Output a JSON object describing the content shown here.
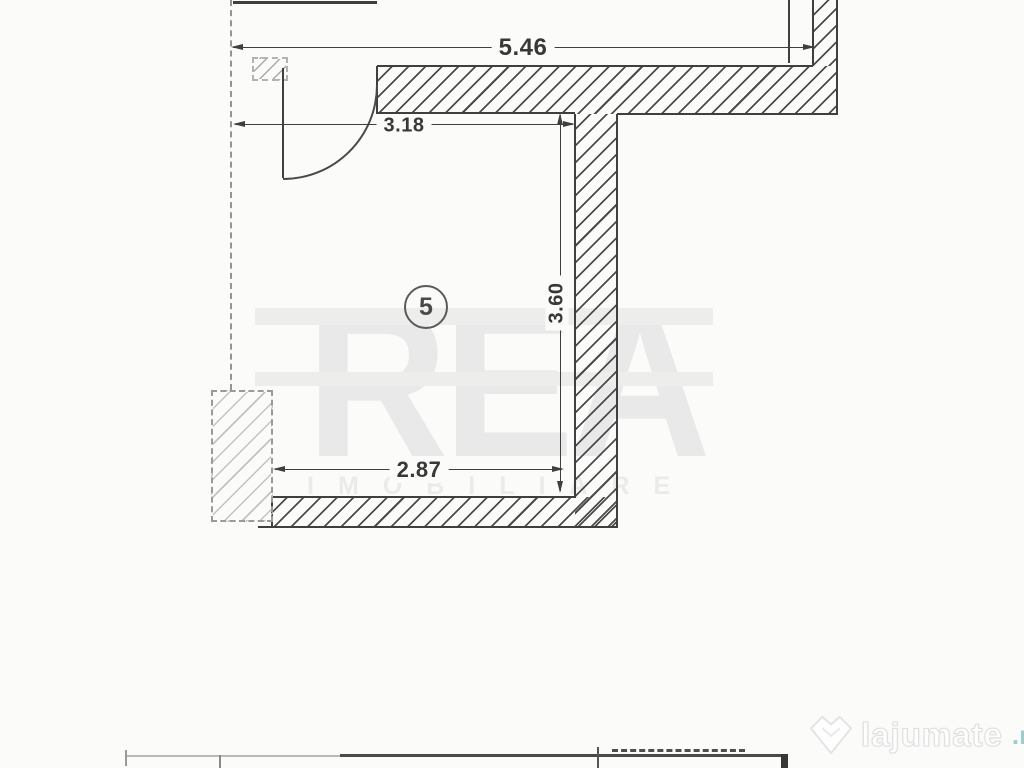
{
  "canvas": {
    "background": "#fbfbfa",
    "ink": "#3f3f3f"
  },
  "plan": {
    "room_number": "5",
    "dimensions": {
      "top": "5.46",
      "door": "3.18",
      "right": "3.60",
      "bottom": "2.87"
    }
  },
  "watermark": {
    "title": "REA",
    "subtitle": "IMOBILIARE",
    "color": "#e9e9e9"
  },
  "logo": {
    "name": "lajumate",
    "tld": ".ro",
    "name_color": "#ffffff",
    "tld_color": "#92cec8"
  }
}
